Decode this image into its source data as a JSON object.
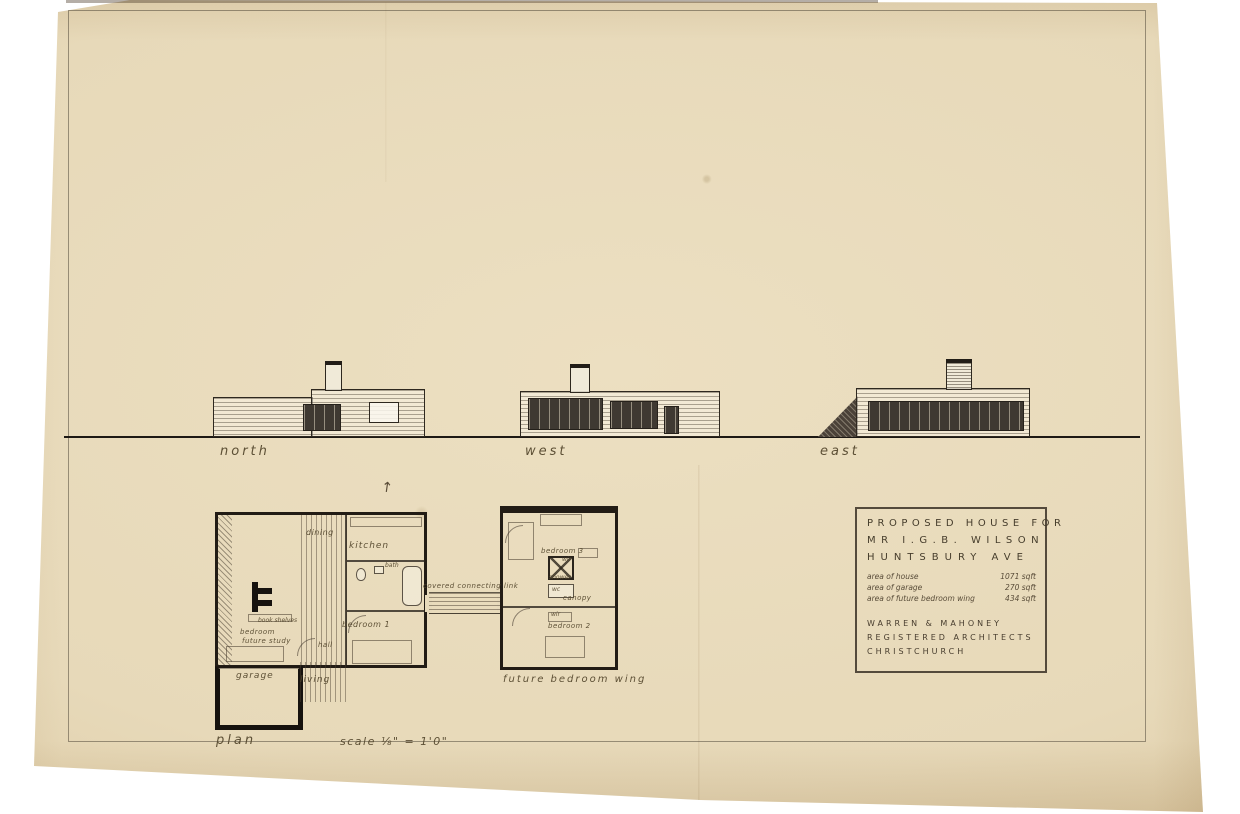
{
  "colors": {
    "paper": "#e8dcbe",
    "ink": "#2b241c",
    "pencil": "#56492f"
  },
  "elevations": {
    "north": {
      "label": "north"
    },
    "west": {
      "label": "west"
    },
    "east": {
      "label": "east"
    }
  },
  "plan": {
    "caption": "plan",
    "scale_note": "scale ⅛\" = 1'0\"",
    "north_arrow_glyph": "↑",
    "rooms": {
      "dining": "dining",
      "kitchen": "kitchen",
      "bath": "bath",
      "bedroom1": "bedroom 1",
      "book_shelves": "book shelves",
      "bedroom_study_line1": "bedroom",
      "bedroom_study_line2": "future study",
      "hall": "hall",
      "garage": "garage",
      "living": "living",
      "covered_link": "covered connecting link",
      "bedroom3": "bedroom 3",
      "wir_a": "wir",
      "shower": "shower",
      "wc": "wc",
      "canopy": "canopy",
      "wir_b": "wir",
      "bedroom2": "bedroom 2",
      "future_wing": "future bedroom wing"
    }
  },
  "title_block": {
    "project_line1": "PROPOSED HOUSE FOR",
    "project_line2": "MR I.G.B. WILSON",
    "project_line3": "HUNTSBURY AVE",
    "areas": [
      {
        "label": "area of house",
        "value": "1071 sqft"
      },
      {
        "label": "area of garage",
        "value": "270 sqft"
      },
      {
        "label": "area of future bedroom wing",
        "value": "434 sqft"
      }
    ],
    "firm_line1": "WARREN & MAHONEY",
    "firm_line2": "REGISTERED ARCHITECTS",
    "firm_line3": "CHRISTCHURCH"
  }
}
